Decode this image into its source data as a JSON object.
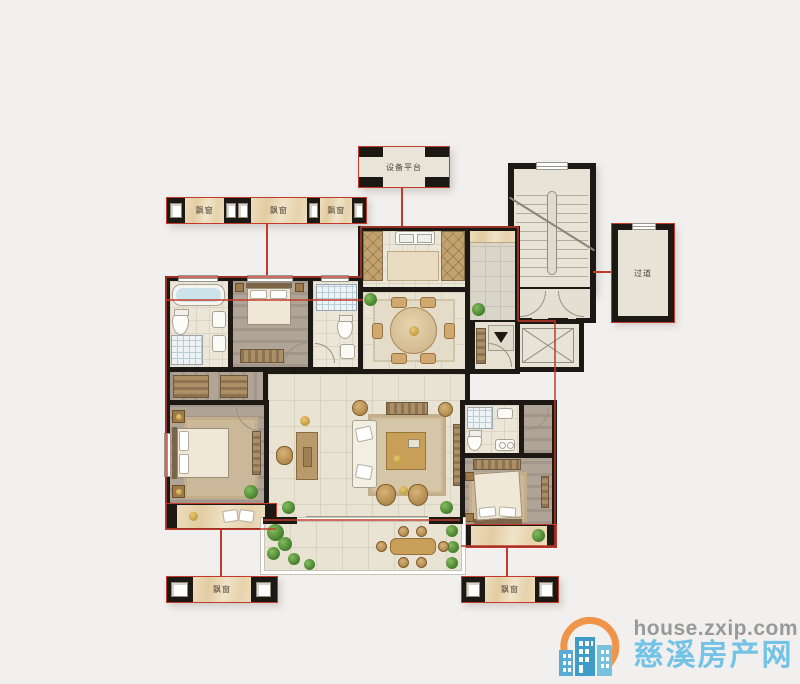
{
  "canvas": {
    "width": 800,
    "height": 684,
    "background": "#f2f0ee"
  },
  "floorplan": {
    "labels": {
      "equipment_platform": "设备平台",
      "corridor": "过道",
      "bay_top_1": "飘窗",
      "bay_top_2": "飘窗",
      "bay_top_3": "飘窗",
      "bay_bottom_left": "飘窗",
      "bay_bottom_right": "飘窗"
    },
    "colors": {
      "wall": "#1c1814",
      "unit_outline_red": "#c23a2c",
      "bay_marble": "#ead8ba",
      "floor_cream": "#e9e3d3",
      "floor_gray": "#d9d5c9",
      "wood_floor": "#a99c8f",
      "shower_blue": "#cde3ea"
    }
  },
  "watermark": {
    "url": "house.zxip.com",
    "site": "慈溪房产网",
    "colors": {
      "arc_orange": "#f0944a",
      "building_blue": "#4fa6d2",
      "url_gray": "#97999b",
      "site_blue": "#74c3e6"
    }
  }
}
